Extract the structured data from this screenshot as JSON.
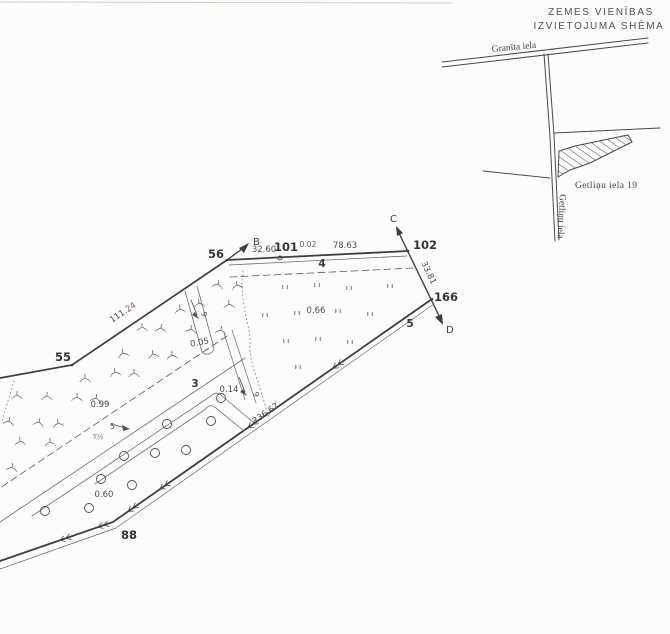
{
  "title": {
    "line1": "ZEMES VIENĪBAS",
    "line2": "IZVIETOJUMA SHĒMA"
  },
  "inset": {
    "street_granita": "Granīta iela",
    "street_getlinu_vertical": "Getliņu iela",
    "parcel_label": "Getliņu iela  19"
  },
  "survey": {
    "points": {
      "p55": "55",
      "p56": "56",
      "p88": "88",
      "p101": "101",
      "p102": "102",
      "p166": "166"
    },
    "directions": {
      "b": "B",
      "c": "C",
      "d": "D"
    },
    "distances": {
      "seg_56_101": "32.60",
      "seg_small": "0.02",
      "seg_101_102": "78.63",
      "seg_102_166": "33.81",
      "seg_55_56_black": "111.",
      "seg_55_56_red": "24",
      "seg_166_88": "236.67"
    },
    "areas": {
      "meadow": "0.66",
      "swamp": "0.99",
      "ditch_strip": "0.05",
      "small_strip": "0.14",
      "orchard": "0.60"
    },
    "parcel_numbers": {
      "n3": "3",
      "n4": "4",
      "n5": "5"
    },
    "ditch_labels": {
      "flow1": "9",
      "flow2": "9",
      "flow3": "5",
      "culvert": "T½"
    }
  },
  "colors": {
    "ink": "#444444",
    "ink_light": "#6e6e6e",
    "red": "#a05068",
    "paper": "#fcfcfb"
  }
}
